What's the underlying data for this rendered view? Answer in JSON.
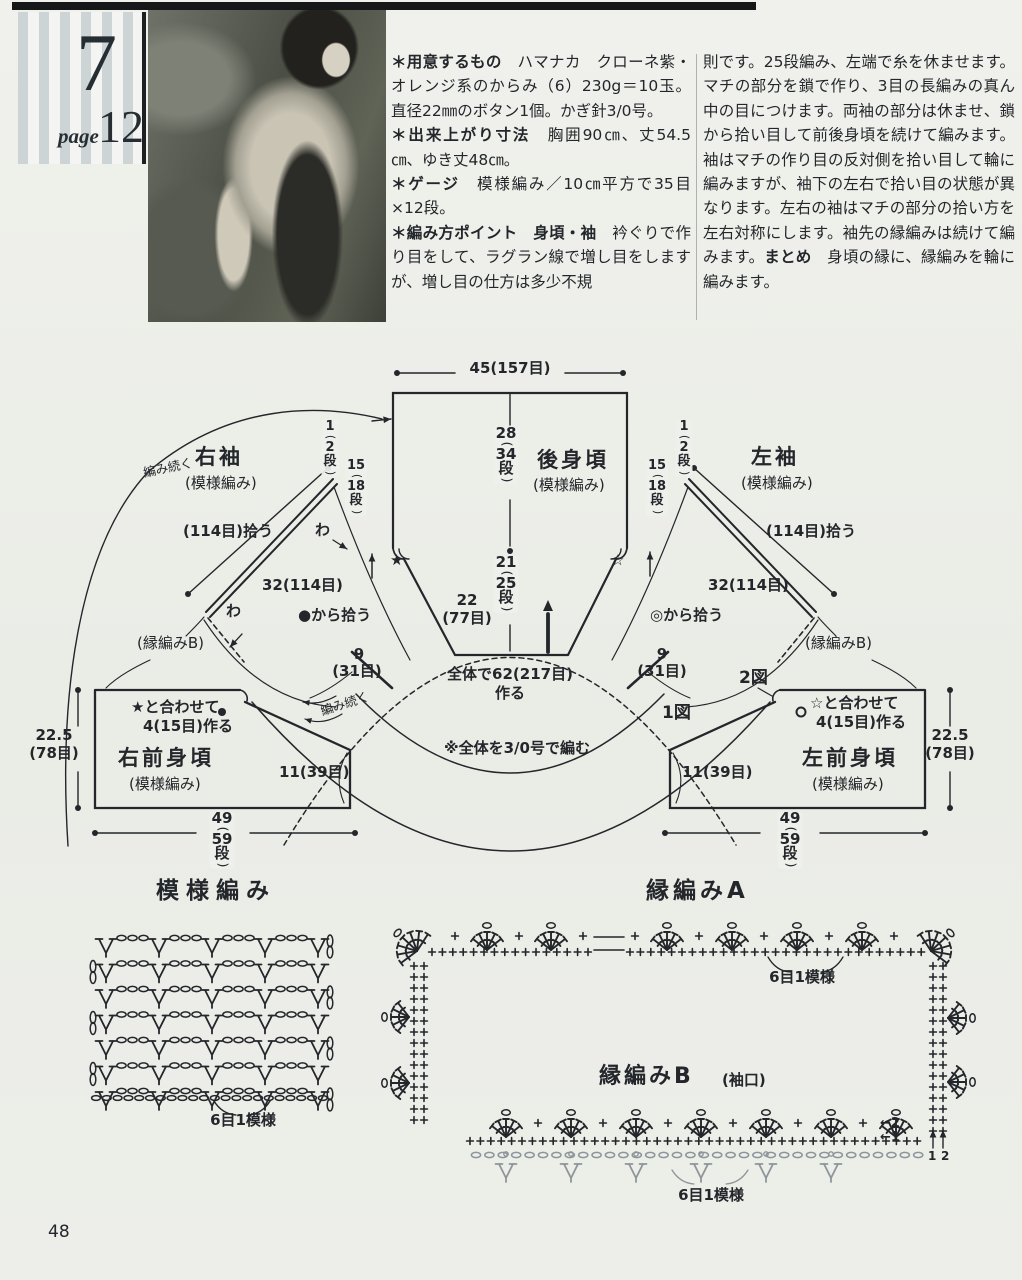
{
  "header": {
    "issue_number": "7",
    "page_word": "page",
    "page_number": "12"
  },
  "footer": {
    "page_number": "48"
  },
  "colors": {
    "ink": "#23262a",
    "paper": "#eef0ea",
    "stripe": "#ccd4d6",
    "gray_symbols": "#8d959a"
  },
  "instructions": {
    "col1": [
      {
        "b": "＊用意するもの",
        "t": "　ハマナカ　クローネ紫・オレンジ系のからみ（6）230g＝10玉。直径22㎜のボタン1個。かぎ針3/0号。"
      },
      {
        "b": "＊出来上がり寸法",
        "t": "　胸囲90㎝、丈54.5㎝、ゆき丈48㎝。"
      },
      {
        "b": "＊ゲージ",
        "t": "　模様編み／10㎝平方で35目×12段。"
      },
      {
        "b": "＊編み方ポイント　身頃・袖",
        "t": "　衿ぐりで作り目をして、ラグラン線で増し目をしますが、増し目の仕方は多少不規"
      }
    ],
    "col2": [
      {
        "b": "",
        "t": "則です。25段編み、左端で糸を休ませます。マチの部分を鎖で作り、3目の長編みの真ん中の目につけます。両袖の部分は休ませ、鎖から拾い目して前後身頃を続けて編みます。袖はマチの作り目の反対側を拾い目して輪に編みますが、袖下の左右で拾い目の状態が異なります。左右の袖はマチの部分の拾い方を左右対称にします。袖先の縁編みは続けて編みます。"
      },
      {
        "b": "まとめ",
        "t": "　身頃の縁に、縁編みを輪に編みます。"
      }
    ]
  },
  "diagram": {
    "top_width": "45(157目)",
    "back": {
      "title": "後身頃",
      "sub": "(模様編み)",
      "rows_upper": [
        "28",
        "(",
        "34",
        "段",
        ")"
      ],
      "rows_lower": [
        "21",
        "(",
        "25",
        "段",
        ")"
      ],
      "neck_w1": "22",
      "neck_w2": "(77目)",
      "star_black": "★",
      "star_white": "☆"
    },
    "right_sleeve": {
      "title": "右袖",
      "sub": "(模様編み)",
      "pickup": "(114目)拾う",
      "line": "32(114目)",
      "from": "●から拾う",
      "wa1": "わ",
      "wa2": "わ",
      "edge": "(縁編みB)",
      "r1": [
        "1",
        "(",
        "2",
        "段",
        ")"
      ],
      "r2": [
        "15",
        "(",
        "18",
        "段",
        ")"
      ],
      "cont": "編み続く",
      "m9": "9",
      "m31": "(31目)"
    },
    "left_sleeve": {
      "title": "左袖",
      "sub": "(模様編み)",
      "pickup": "(114目)拾う",
      "line": "32(114目)",
      "from": "◎から拾う",
      "edge": "(縁編みB)",
      "r1": [
        "1",
        "(",
        "2",
        "段",
        ")"
      ],
      "r2": [
        "15",
        "(",
        "18",
        "段",
        ")"
      ],
      "m9": "9",
      "m31": "(31目)",
      "fig1": "1図",
      "fig2": "2図"
    },
    "center": {
      "cast": "全体で62(217目)",
      "cast2": "作る",
      "hook_note": "※全体を3/0号で編む"
    },
    "right_front": {
      "title": "右前身頃",
      "sub": "(模様編み)",
      "note1": "★と合わせて",
      "note2": "4(15目)作る",
      "w1": "22.5",
      "w2": "(78目)",
      "m11": "11(39目)",
      "rows": [
        "49",
        "(",
        "59",
        "段",
        ")"
      ],
      "cont": "編み続く"
    },
    "left_front": {
      "title": "左前身頃",
      "sub": "(模様編み)",
      "note1": "☆と合わせて",
      "note2": "4(15目)作る",
      "w1": "22.5",
      "w2": "(78目)",
      "m11": "11(39目)",
      "rows": [
        "49",
        "(",
        "59",
        "段",
        ")"
      ]
    }
  },
  "charts": {
    "pattern": {
      "title": "模様編み",
      "repeat": "6目1模様"
    },
    "edge_a": {
      "title": "縁編みA",
      "repeat": "6目1模様",
      "row_nums": [
        "1",
        "2"
      ]
    },
    "edge_b": {
      "title": "縁編みB",
      "sub": "(袖口)",
      "repeat": "6目1模様",
      "row1": "←1",
      "row2": "←2"
    }
  }
}
